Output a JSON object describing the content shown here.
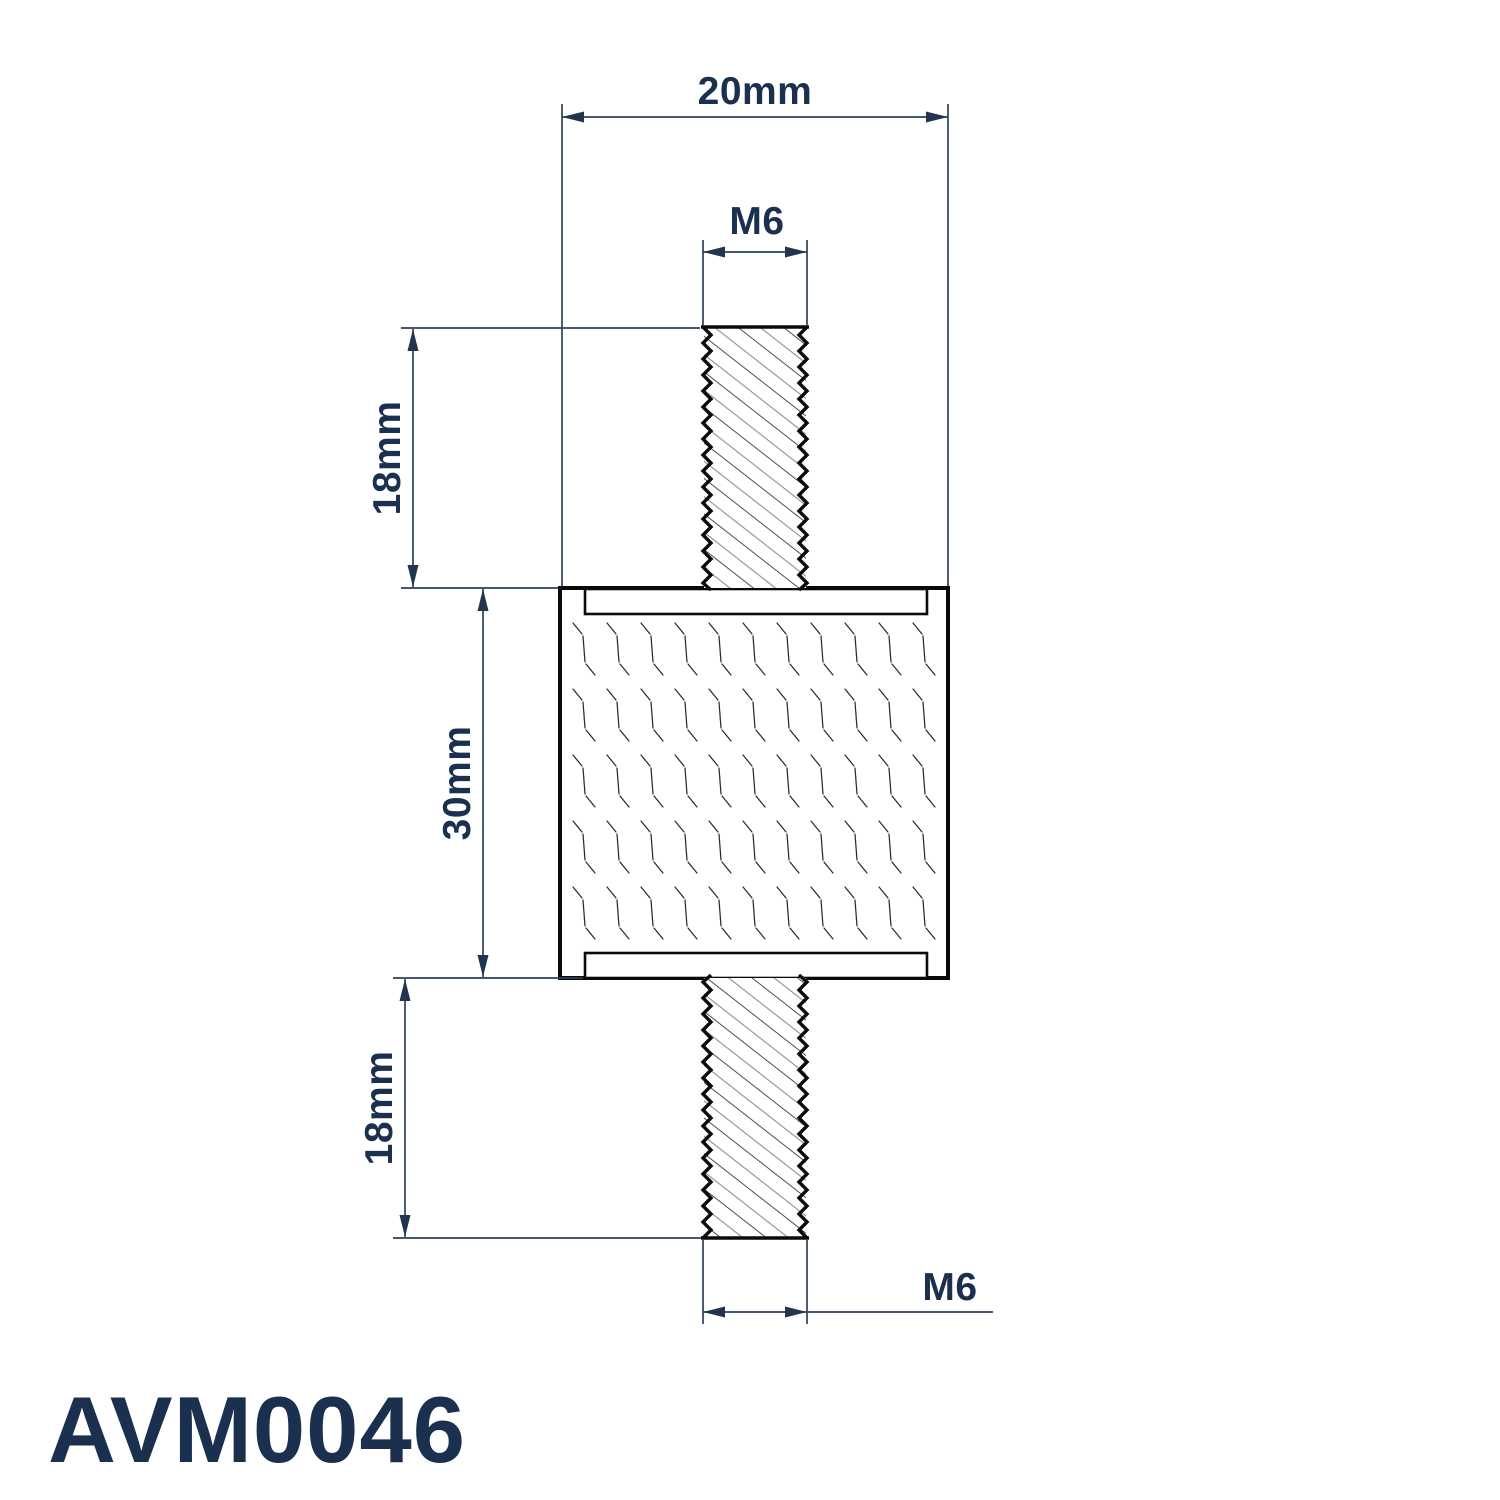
{
  "part": {
    "number": "AVM0046",
    "type_description": "anti-vibration mount, male-male threaded studs, section view"
  },
  "annotations": {
    "overall_width": "20mm",
    "top_thread": "M6",
    "top_stud_length": "18mm",
    "body_height": "30mm",
    "bottom_stud_length": "18mm",
    "bottom_thread": "M6"
  },
  "colors": {
    "background": "#ffffff",
    "drawing_outline": "#0a0a0a",
    "dimension_line": "#2e4057",
    "annotation_text": "#1b2f4f",
    "hatch_secondary": "#8f8f8f"
  }
}
